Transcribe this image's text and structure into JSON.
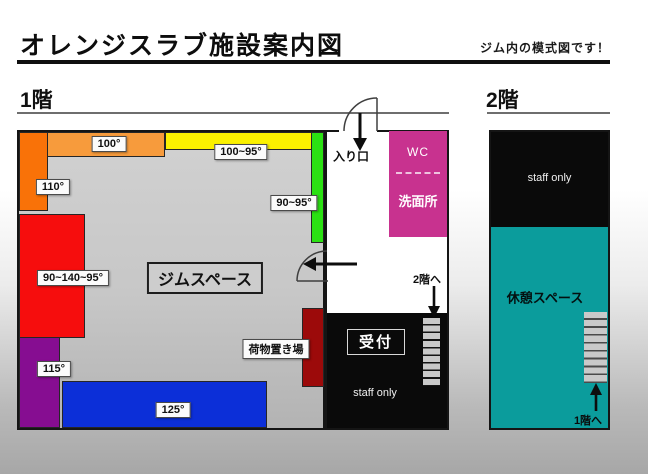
{
  "page": {
    "title": "オレンジスラブ施設案内図",
    "subtitle": "ジム内の模式図です！"
  },
  "floor1": {
    "heading": "1階",
    "gym_area_label": "ジムスペース",
    "entrance_label": "入り口",
    "walls": [
      {
        "name": "orange-top-wall",
        "label": "100°",
        "color": "#F79B3C"
      },
      {
        "name": "orange-left-wall",
        "label": "110°",
        "color": "#F97208"
      },
      {
        "name": "yellow-top-wall",
        "label": "100~95°",
        "color": "#FBF100"
      },
      {
        "name": "green-right-wall",
        "label": "90~95°",
        "color": "#2BE113"
      },
      {
        "name": "red-left-wall",
        "label": "90~140~95°",
        "color": "#F60D0D"
      },
      {
        "name": "purple-left-wall",
        "label": "115°",
        "color": "#860D91"
      },
      {
        "name": "blue-bottom-wall",
        "label": "125°",
        "color": "#0C2FD8"
      }
    ],
    "storage": {
      "label": "荷物置き場",
      "color": "#9C0A0A"
    },
    "wc": {
      "line1": "WC",
      "line2": "洗面所",
      "color": "#C8328F"
    },
    "to_floor2_label": "2階へ",
    "reception_label": "受付",
    "staff_only_label": "staff only"
  },
  "floor2": {
    "heading": "2階",
    "staff_only_label": "staff only",
    "rest_area_label": "休憩スペース",
    "rest_area_color": "#0B9C9C",
    "to_floor1_label": "1階へ"
  }
}
